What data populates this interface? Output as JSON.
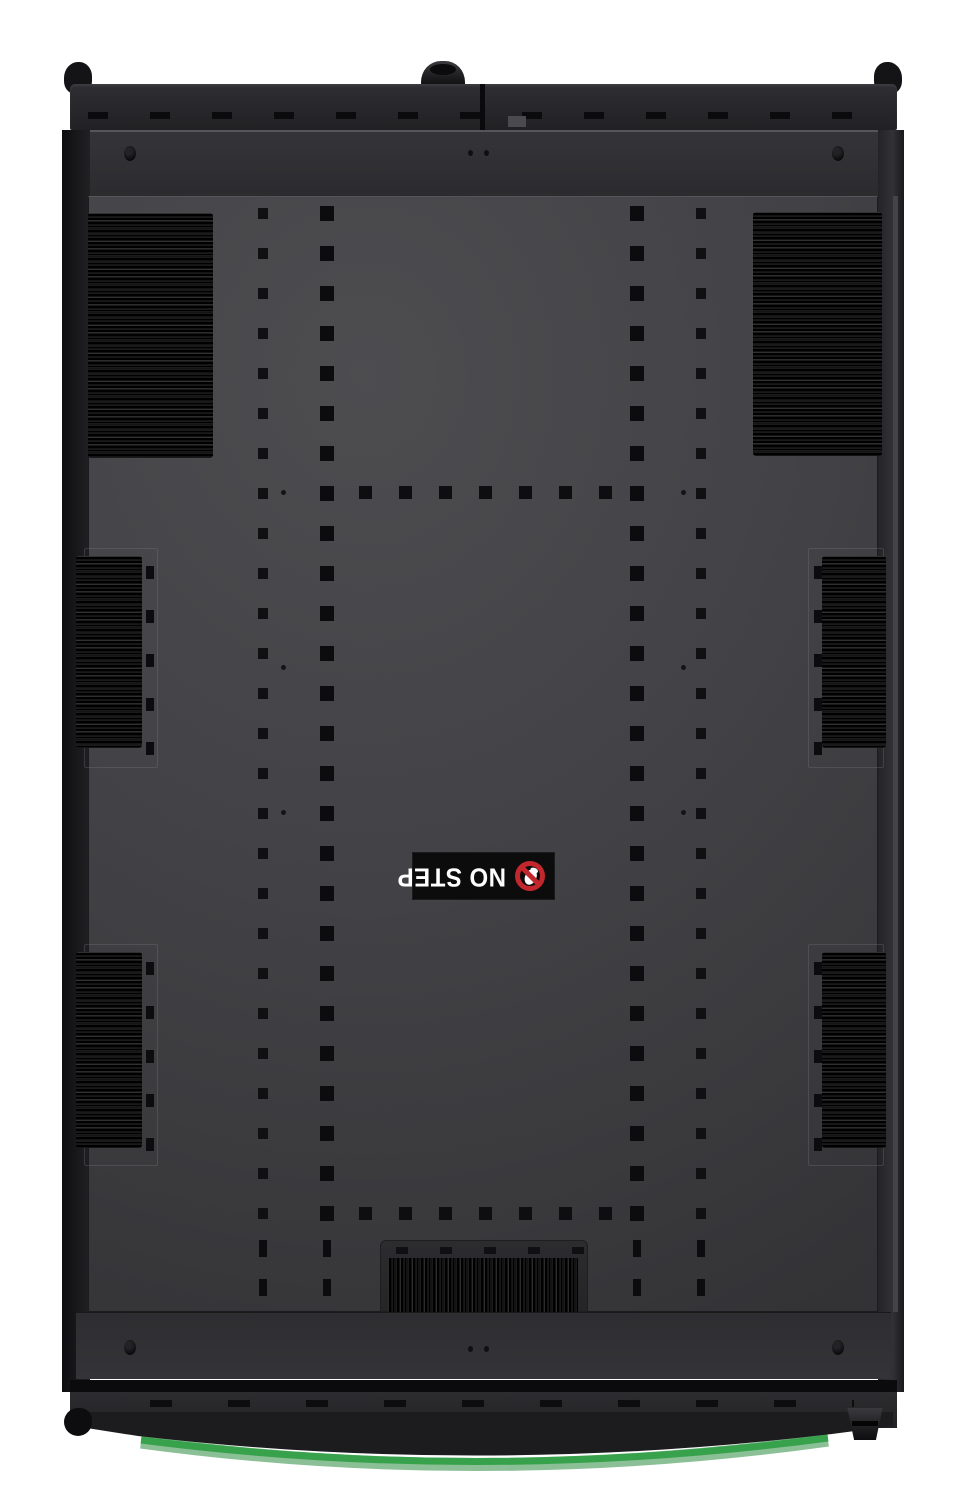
{
  "scene": {
    "type": "product-photo",
    "subject": "black server-rack roof panel seen from above with brush cable-entry strips",
    "background_color": "#ffffff",
    "panel_color": "#434347",
    "accent_green": "#37a24b"
  },
  "no_step_label": {
    "text": "NO STEP",
    "background": "#0c0c0c",
    "text_color": "#ffffff",
    "symbol": "no-step-prohibition",
    "symbol_color": "#c1272d",
    "rotation_deg": 180
  }
}
